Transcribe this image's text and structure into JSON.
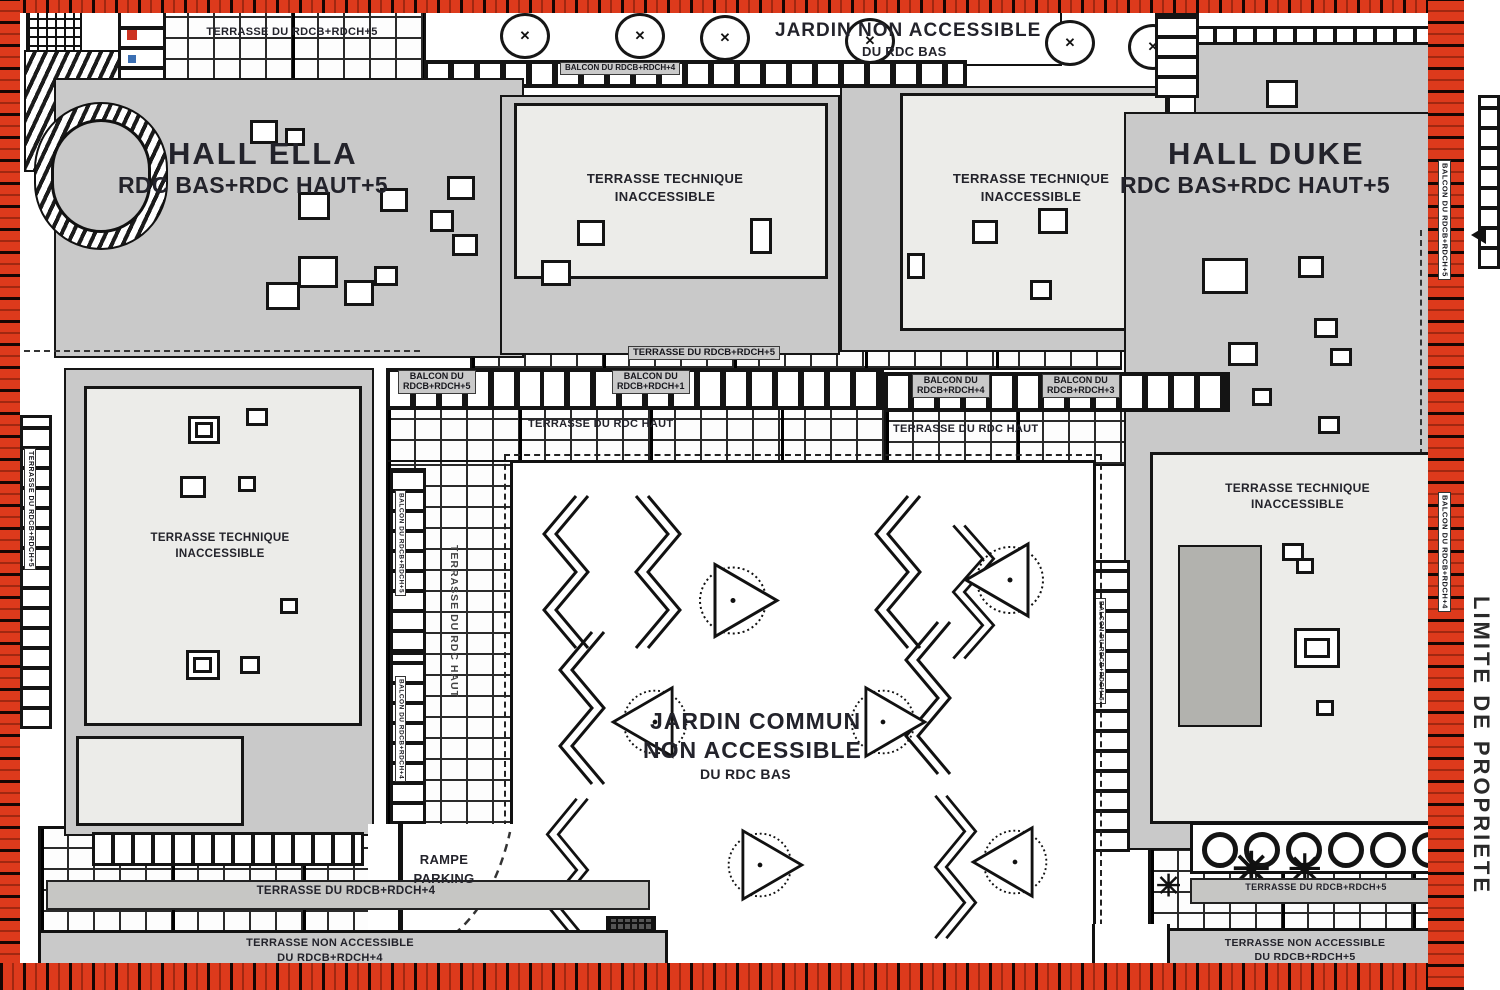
{
  "colors": {
    "boundary_red": "#dd3a1c",
    "building_gray": "#c9c9c9",
    "terrace_light": "#ecece9",
    "line": "#151515",
    "text": "#23232b"
  },
  "icons": {
    "tree_mark": "✕",
    "conifer": "✳"
  },
  "halls": {
    "ella_name": "HALL ELLA",
    "ella_levels": "RDC BAS+RDC HAUT+5",
    "duke_name": "HALL DUKE",
    "duke_levels": "RDC BAS+RDC HAUT+5"
  },
  "top": {
    "terrasse": "TERRASSE DU RDCB+RDCH+5",
    "balcon": "BALCON DU RDCB+RDCH+4",
    "jardin_l1": "JARDIN NON ACCESSIBLE",
    "jardin_l2": "DU RDC BAS"
  },
  "tech": {
    "l1": "TERRASSE TECHNIQUE",
    "l2": "INACCESSIBLE"
  },
  "mid": {
    "terrasse_5": "TERRASSE DU RDCB+RDCH+5",
    "terrasse_haut": "TERRASSE DU RDC HAUT",
    "balcon_left_l1": "BALCON DU",
    "balcon_left_l2": "RDCB+RDCH+5",
    "balcon_center_l1": "BALCON DU",
    "balcon_center_l2": "RDCB+RDCH+1",
    "balcon_r1_l1": "BALCON DU",
    "balcon_r1_l2": "RDCB+RDCH+4",
    "balcon_r2_l1": "BALCON DU",
    "balcon_r2_l2": "RDCB+RDCH+3"
  },
  "garden": {
    "l1": "JARDIN COMMUN",
    "l2": "NON ACCESSIBLE",
    "l3": "DU RDC BAS"
  },
  "bottom": {
    "rampe_l1": "RAMPE",
    "rampe_l2": "PARKING",
    "terrasse_left": "TERRASSE DU RDCB+RDCH+4",
    "nonacc_left_l1": "TERRASSE NON ACCESSIBLE",
    "nonacc_left_l2": "DU RDCB+RDCH+4",
    "terrasse_right": "TERRASSE DU RDCB+RDCH+5",
    "nonacc_right_l1": "TERRASSE NON ACCESSIBLE",
    "nonacc_right_l2": "DU RDCB+RDCH+5"
  },
  "edges": {
    "limite": "LIMITE DE PROPRIETE",
    "left_vertical": "TERRASSE DU RDCB+RDCH+5",
    "right_vertical_top": "BALCON DU RDCB+RDCH+5",
    "right_vertical_mid": "BALCON DU RDCB+RDCH+4",
    "inner_left_1": "BALCON DU RDCB+RDCH+5",
    "inner_left_2": "BALCON DU RDCB+RDCH+4",
    "inner_right": "BALCON DU RDCB+RDCH+5",
    "terrasse_haut_vertical": "TERRASSE DU RDC HAUT"
  }
}
